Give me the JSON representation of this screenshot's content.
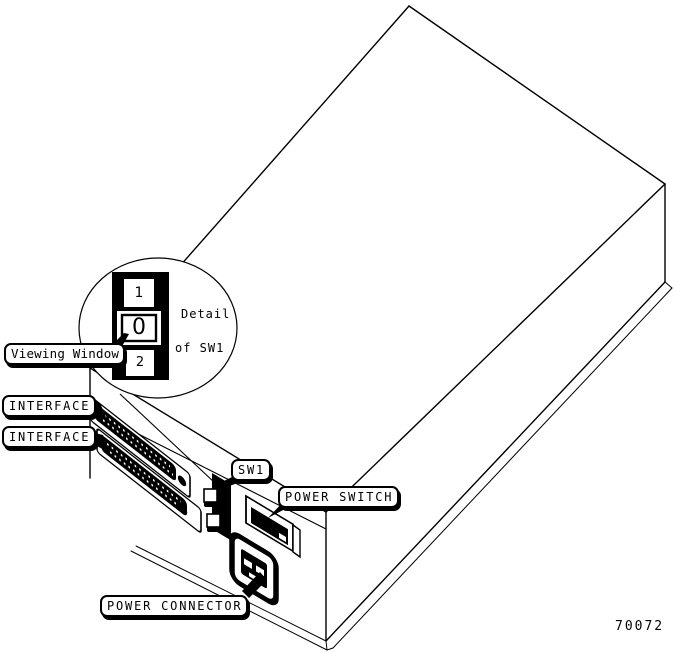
{
  "colors": {
    "ink": "#000000",
    "paper": "#ffffff"
  },
  "callouts": {
    "viewing_window": "Viewing Window",
    "interface_top": "INTERFACE",
    "interface_bottom": "INTERFACE",
    "sw1": "SW1",
    "power_switch": "POWER SWITCH",
    "power_connector": "POWER CONNECTOR"
  },
  "detail_inset": {
    "caption_line_1": "Detail",
    "caption_line_2": "of SW1",
    "switch_positions": {
      "top": "1",
      "middle": "0",
      "bottom": "2"
    }
  },
  "figure_number": "70072"
}
